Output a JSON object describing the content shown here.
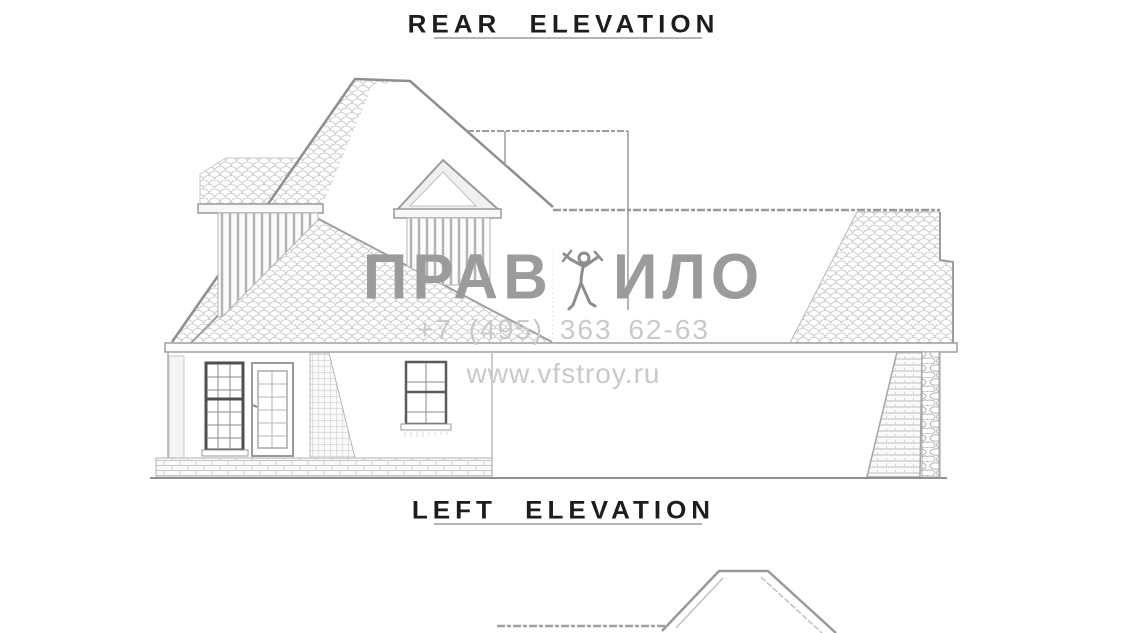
{
  "titles": {
    "top": "REAR ELEVATION",
    "bottom": "LEFT ELEVATION",
    "color": "#1d1d1d",
    "underline_color": "#b3b3b3"
  },
  "watermark": {
    "brand_left": "ПРАВ",
    "brand_right": "ИЛО",
    "icon": "worker-figure-icon",
    "phone": "+7 (495) 363 62-63",
    "url": "www.vfstroy.ru",
    "brand_color": "#9b9b9b",
    "contact_color": "#c9c9c9"
  },
  "drawing": {
    "type": "architectural-elevations",
    "line_color": "#8f8f8f",
    "shingle_texture_color": "#cdcdcd",
    "window_frame_color": "#4f4f4f",
    "views": [
      {
        "name": "rear-elevation-house",
        "label_ref": "titles.top"
      },
      {
        "name": "left-elevation-roof-partial",
        "label_ref": "titles.bottom"
      }
    ]
  }
}
